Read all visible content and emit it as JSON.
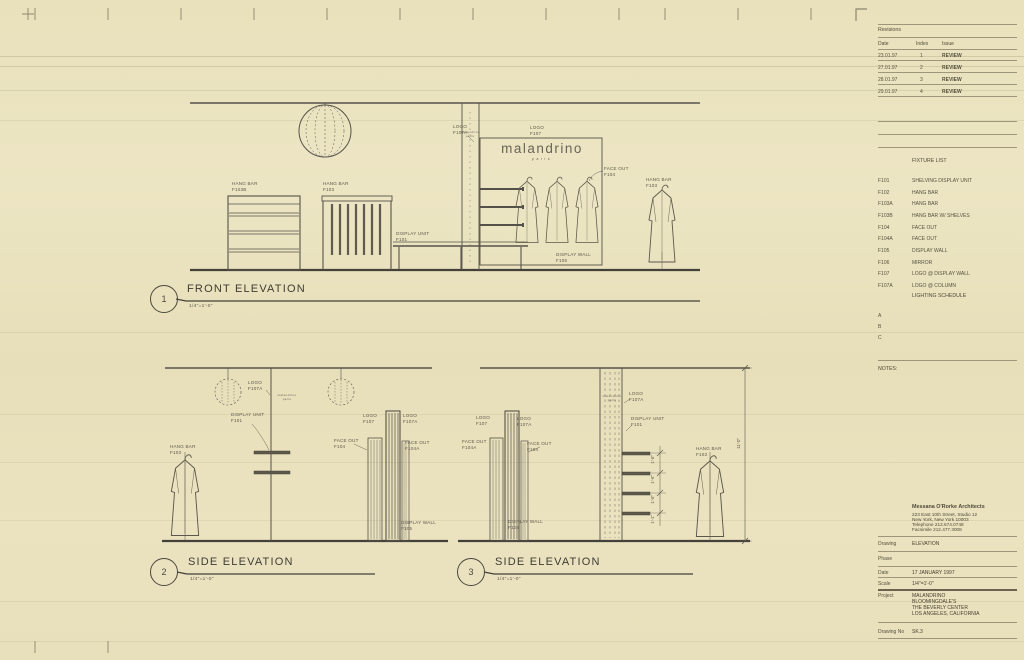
{
  "titles": {
    "front": {
      "num": "1",
      "title": "FRONT ELEVATION",
      "scale": "1/4\"=1'-0\""
    },
    "side2": {
      "num": "2",
      "title": "SIDE ELEVATION",
      "scale": "1/4\"=1'-0\""
    },
    "side3": {
      "num": "3",
      "title": "SIDE ELEVATION",
      "scale": "1/4\"=1'-0\""
    }
  },
  "logo": {
    "name": "malandrino",
    "sub": "paris"
  },
  "ann": {
    "fe_hb_l": {
      "a": "HANG BAR",
      "b": "F103B"
    },
    "fe_hb_m": {
      "a": "HANG BAR",
      "b": "F103"
    },
    "fe_du": {
      "a": "DISPLAY UNIT",
      "b": "F101"
    },
    "fe_logo_col": {
      "a": "LOGO",
      "b": "F107A"
    },
    "fe_logo_wall": {
      "a": "LOGO",
      "b": "F107"
    },
    "fe_fo": {
      "a": "FACE OUT",
      "b": "F104"
    },
    "fe_dw": {
      "a": "DISPLAY WALL",
      "b": "F105"
    },
    "fe_hb_r": {
      "a": "HANG BAR",
      "b": "F103"
    },
    "s2_logo_col": {
      "a": "LOGO",
      "b": "F107A"
    },
    "s2_du": {
      "a": "DISPLAY UNIT",
      "b": "F101"
    },
    "s2_hb": {
      "a": "HANG BAR",
      "b": "F103"
    },
    "s2_logo1": {
      "a": "LOGO",
      "b": "F107"
    },
    "s2_logo2": {
      "a": "LOGO",
      "b": "F107A"
    },
    "s2_fo1": {
      "a": "FACE OUT",
      "b": "F104"
    },
    "s2_fo2": {
      "a": "FACE OUT",
      "b": "F104A"
    },
    "s2_dw": {
      "a": "DISPLAY WALL",
      "b": "F105"
    },
    "s3_logo1": {
      "a": "LOGO",
      "b": "F107"
    },
    "s3_logo2": {
      "a": "LOGO",
      "b": "F107A"
    },
    "s3_fo1": {
      "a": "FACE OUT",
      "b": "F104A"
    },
    "s3_fo2": {
      "a": "FACE OUT",
      "b": "F104"
    },
    "s3_dw": {
      "a": "DISPLAY WALL",
      "b": "F105"
    },
    "s3_logo_col": {
      "a": "LOGO",
      "b": "F107A"
    },
    "s3_du": {
      "a": "DISPLAY UNIT",
      "b": "F101"
    },
    "s3_hb": {
      "a": "HANG BAR",
      "b": "F103"
    }
  },
  "dims": {
    "overall": "11'-0\"",
    "d1": "1'-6\"",
    "d2": "1'-6\"",
    "d3": "1'-6\"",
    "d4": "1'-1\""
  },
  "revisions": {
    "title": "Revisions",
    "col_date": "Date",
    "col_index": "Index",
    "col_issue": "Issue",
    "rows": [
      {
        "date": "23.01.97",
        "index": "1",
        "issue": "REVIEW"
      },
      {
        "date": "27.01.97",
        "index": "2",
        "issue": "REVIEW"
      },
      {
        "date": "28.01.97",
        "index": "3",
        "issue": "REVIEW"
      },
      {
        "date": "29.01.97",
        "index": "4",
        "issue": "REVIEW"
      }
    ]
  },
  "fixture_list": {
    "title": "FIXTURE LIST",
    "items": [
      {
        "code": "F101",
        "desc": "SHELVING DISPLAY UNIT"
      },
      {
        "code": "F102",
        "desc": "HANG BAR"
      },
      {
        "code": "F103A",
        "desc": "HANG BAR"
      },
      {
        "code": "F103B",
        "desc": "HANG BAR W/ SHELVES"
      },
      {
        "code": "F104",
        "desc": "FACE OUT"
      },
      {
        "code": "F104A",
        "desc": "FACE OUT"
      },
      {
        "code": "F105",
        "desc": "DISPLAY WALL"
      },
      {
        "code": "F106",
        "desc": "MIRROR"
      },
      {
        "code": "F107",
        "desc": "LOGO @ DISPLAY WALL"
      },
      {
        "code": "F107A",
        "desc": "LOGO @ COLUMN"
      }
    ]
  },
  "lighting": {
    "title": "LIGHTING SCHEDULE",
    "a": "A",
    "b": "B",
    "c": "C"
  },
  "notes_label": "NOTES:",
  "firm": {
    "name": "Messana O'Rorke Architects",
    "address1": "223 East 10th Street, Studio 12",
    "address2": "New York, New York 10003",
    "phone": "Telephone  212.674.0748",
    "fax": "Facsimile  212.477.3008"
  },
  "info": {
    "drawing_label": "Drawing",
    "drawing_value": "ELEVATION",
    "phase_label": "Phase",
    "phase_value": "",
    "date_label": "Date",
    "date_value": "17 JANUARY 1997",
    "scale_label": "Scale",
    "scale_value": "1/4\"=1'-0\"",
    "project_label": "Project",
    "project_lines": [
      "MALANDRINO",
      "BLOOMINGDALE'S",
      "THE BEVERLY CENTER",
      "LOS ANGELES, CALIFORNIA"
    ],
    "drawing_no_label": "Drawing No",
    "drawing_no_value": "SK.3"
  }
}
